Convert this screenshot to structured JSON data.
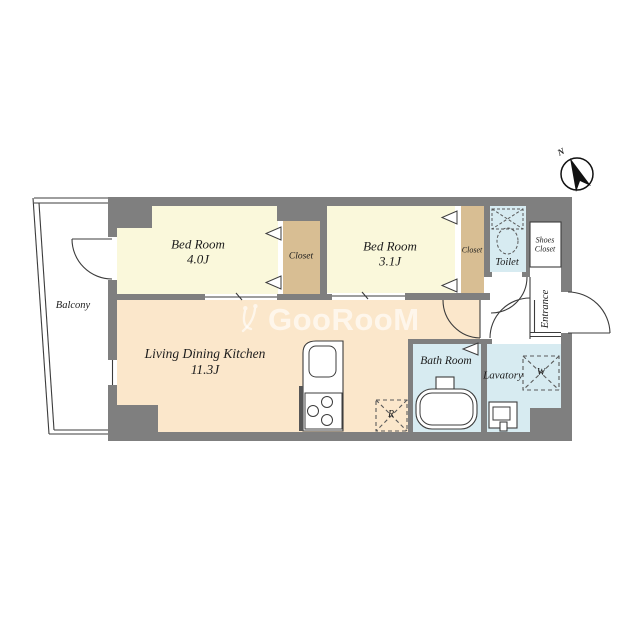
{
  "compass": {
    "label": "N"
  },
  "watermark": {
    "text": "GooRooM"
  },
  "rooms": {
    "balcony": {
      "label": "Balcony"
    },
    "bedroom1": {
      "name": "Bed Room",
      "size": "4.0J"
    },
    "closet1": {
      "label": "Closet"
    },
    "bedroom2": {
      "name": "Bed Room",
      "size": "3.1J"
    },
    "closet2": {
      "label": "Closet"
    },
    "toilet": {
      "label": "Toilet"
    },
    "shoes_closet": {
      "line1": "Shoes",
      "line2": "Closet"
    },
    "entrance": {
      "label": "Entrance"
    },
    "ldk": {
      "name": "Living Dining Kitchen",
      "size": "11.3J"
    },
    "bathroom": {
      "label": "Bath Room"
    },
    "lavatory": {
      "label": "Lavatory"
    },
    "washing_machine": {
      "label": "W"
    },
    "refrigerator": {
      "label": "R"
    }
  },
  "colors": {
    "wall": "#7f7f7f",
    "bedroom": "#faf8db",
    "ldk": "#fbe7cb",
    "closet": "#d8be93",
    "wet": "#d7ebf1"
  }
}
